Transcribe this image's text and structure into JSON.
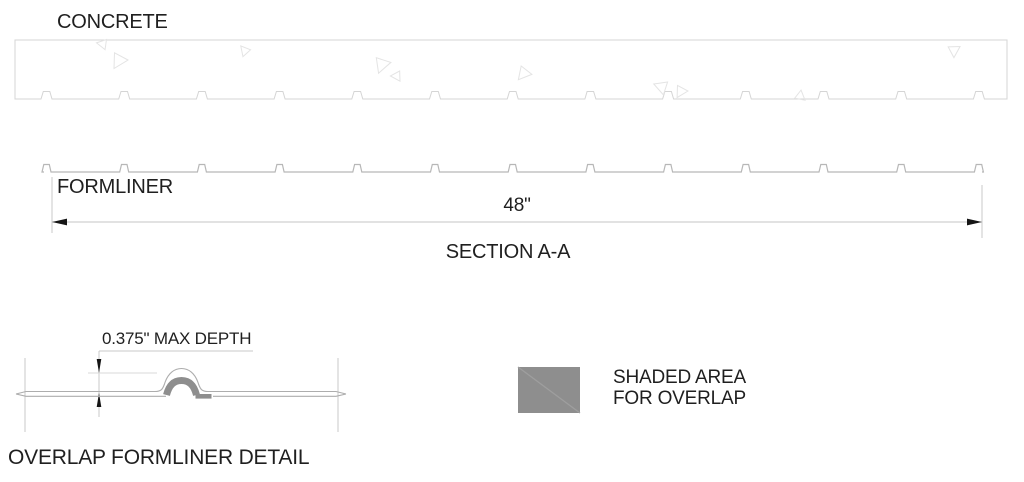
{
  "labels": {
    "concrete": "CONCRETE",
    "formliner": "FORMLINER",
    "dimension_48": "48\"",
    "section_title": "SECTION A-A",
    "max_depth": "0.375\" MAX DEPTH",
    "legend_line1": "SHADED AREA",
    "legend_line2": "FOR OVERLAP",
    "detail_title": "OVERLAP FORMLINER DETAIL"
  },
  "colors": {
    "background": "#ffffff",
    "text": "#1f1f1f",
    "concrete_outline": "#d5d5d5",
    "formliner_line": "#b7b7b7",
    "dimension_line": "#c6c6c6",
    "arrow": "#151515",
    "overlap_shade": "#8e8e8e",
    "legend_diagonal": "#9e9e9e",
    "texture": "#e4e4e4"
  },
  "geometry": {
    "concrete": {
      "x": 15,
      "y": 40,
      "w": 992,
      "h": 59
    },
    "ribs": {
      "count": 13,
      "start_x": 46.5,
      "spacing": 77.7,
      "base_w": 11,
      "top_w": 6.5,
      "height": 7.5
    },
    "formliner": {
      "y": 172,
      "x1": 44,
      "x2": 982,
      "bump_h": 7.5
    },
    "dimension": {
      "y": 222,
      "x1": 52,
      "x2": 982
    }
  },
  "texture_triangles": [
    {
      "x": 103,
      "y": 44,
      "s": 6,
      "r": 160
    },
    {
      "x": 119,
      "y": 60,
      "s": 9,
      "r": 90
    },
    {
      "x": 245,
      "y": 51,
      "s": 6,
      "r": 200
    },
    {
      "x": 382,
      "y": 64,
      "s": 9,
      "r": 80
    },
    {
      "x": 397,
      "y": 76,
      "s": 6,
      "r": 150
    },
    {
      "x": 524,
      "y": 73,
      "s": 8,
      "r": 100
    },
    {
      "x": 662,
      "y": 87,
      "s": 8,
      "r": 170
    },
    {
      "x": 681,
      "y": 91,
      "s": 7,
      "r": 90
    },
    {
      "x": 800,
      "y": 96,
      "s": 6,
      "r": 10
    },
    {
      "x": 954,
      "y": 50,
      "s": 7,
      "r": 60
    }
  ]
}
